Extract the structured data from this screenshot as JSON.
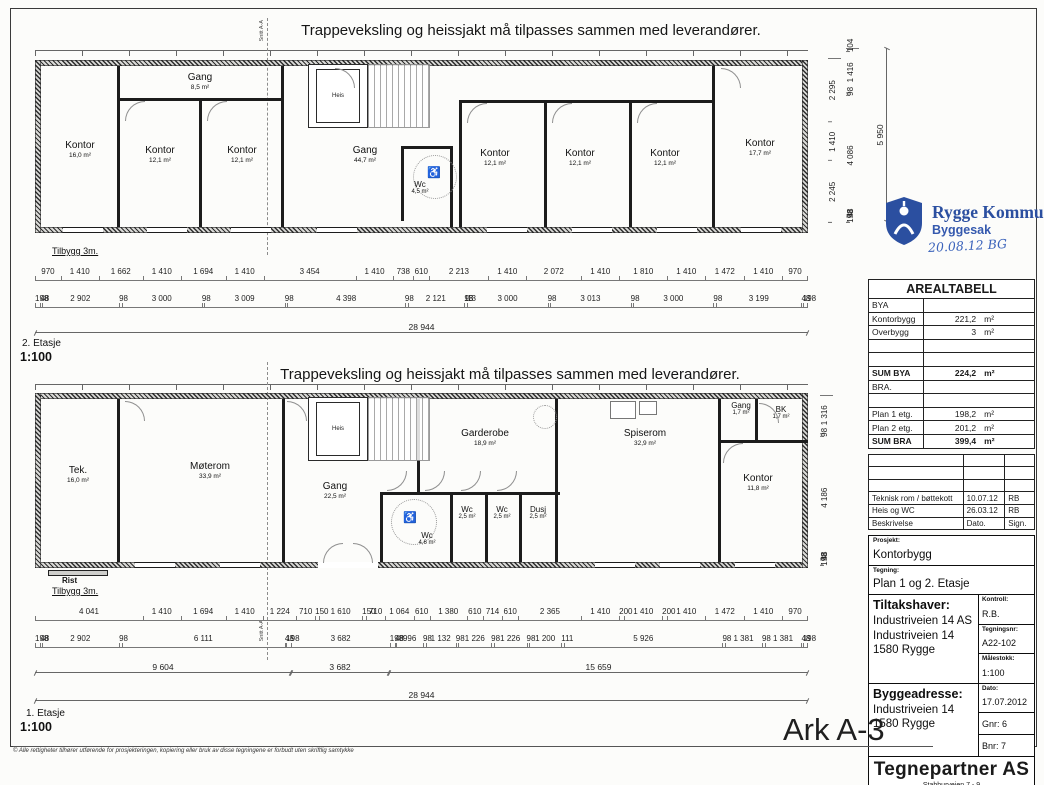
{
  "notes": {
    "top": "Trappeveksling og heissjakt må tilpasses sammen med leverandører.",
    "bottom": "Trappeveksling og heissjakt må tilpasses sammen med leverandører."
  },
  "section_label": "Snitt A-A",
  "ark": "Ark A-3",
  "copyright": "© Alle rettigheter tilhører utførende for prosjekteringen, kopiering eller bruk av disse tegningene er forbudt uten skriftlig samtykke",
  "stamp": {
    "name": "Rygge Kommune",
    "dept": "Byggesak",
    "handwritten": "20.08.12 BG",
    "color": "#2b4fa0"
  },
  "plan2": {
    "floor": "2. Etasje",
    "scale": "1:100",
    "tilbygg": "Tilbygg 3m.",
    "rooms": [
      {
        "name": "Kontor",
        "area": "16,0 m²"
      },
      {
        "name": "Gang",
        "area": "8,5 m²"
      },
      {
        "name": "Kontor",
        "area": "12,1 m²"
      },
      {
        "name": "Kontor",
        "area": "12,1 m²"
      },
      {
        "name": "Heis",
        "area": ""
      },
      {
        "name": "Gang",
        "area": "44,7 m²"
      },
      {
        "name": "Wc",
        "area": "4,5 m²"
      },
      {
        "name": "Kontor",
        "area": "12,1 m²"
      },
      {
        "name": "Kontor",
        "area": "12,1 m²"
      },
      {
        "name": "Kontor",
        "area": "12,1 m²"
      },
      {
        "name": "Kontor",
        "area": "17,7 m²"
      }
    ],
    "dims": {
      "row1": [
        "970",
        "1 410",
        "1 662",
        "1 410",
        "1 694",
        "1 410",
        "3 454",
        "1 410",
        "738",
        "610",
        "2 213",
        "1 410",
        "2 072",
        "1 410",
        "1 810",
        "1 410",
        "1 472",
        "1 410",
        "970"
      ],
      "row2": [
        "198",
        "48",
        "2 902",
        "98",
        "3 000",
        "98",
        "3 009",
        "98",
        "4 398",
        "98",
        "2 121",
        "13",
        "98",
        "13",
        "3 000",
        "98",
        "3 013",
        "98",
        "3 000",
        "98",
        "3 199",
        "48",
        "198"
      ],
      "total": "28 944",
      "right_inner": [
        "2 295",
        "1 410",
        "2 245"
      ],
      "right_outer": [
        "104",
        "1 416",
        "98",
        "4 086",
        "48",
        "198"
      ],
      "right_total": "5 950"
    }
  },
  "plan1": {
    "floor": "1. Etasje",
    "scale": "1:100",
    "tilbygg": "Tilbygg 3m.",
    "rist": "Rist",
    "rooms": [
      {
        "name": "Tek.",
        "area": "16,0 m²"
      },
      {
        "name": "Møterom",
        "area": "33,9 m²"
      },
      {
        "name": "Heis",
        "area": ""
      },
      {
        "name": "Gang",
        "area": "22,5 m²"
      },
      {
        "name": "Garderobe",
        "area": "18,9 m²"
      },
      {
        "name": "Wc",
        "area": "4,6 m²"
      },
      {
        "name": "Wc",
        "area": "2,5 m²"
      },
      {
        "name": "Wc",
        "area": "2,5 m²"
      },
      {
        "name": "Dusj",
        "area": "2,5 m²"
      },
      {
        "name": "Spiserom",
        "area": "32,9 m²"
      },
      {
        "name": "Gang",
        "area": "1,7 m²"
      },
      {
        "name": "BK",
        "area": "1,7 m²"
      },
      {
        "name": "Kontor",
        "area": "11,8 m²"
      }
    ],
    "dims": {
      "row1": [
        "4 041",
        "1 410",
        "1 694",
        "1 410",
        "1 224",
        "710",
        "150",
        "1 610",
        "150",
        "710",
        "1 064",
        "610",
        "1 380",
        "610",
        "714",
        "610",
        "2 365",
        "1 410",
        "200",
        "1 410",
        "200",
        "1 410",
        "1 472",
        "1 410",
        "970"
      ],
      "row2": [
        "198",
        "48",
        "2 902",
        "98",
        "6 111",
        "48",
        "198",
        "3 682",
        "198",
        "48",
        "996",
        "98",
        "1 132",
        "98",
        "1 226",
        "98",
        "1 226",
        "98",
        "1 200",
        "111",
        "5 926",
        "98",
        "1 381",
        "98",
        "1 381",
        "48",
        "198"
      ],
      "row3": [
        "9 604",
        "3 682",
        "15 659"
      ],
      "total": "28 944",
      "right": [
        "1 316",
        "98",
        "4 186",
        "48",
        "198"
      ]
    }
  },
  "arealtabell": {
    "title": "AREALTABELL",
    "rows": [
      {
        "label": "BYA",
        "value": "",
        "unit": ""
      },
      {
        "label": "Kontorbygg",
        "value": "221,2",
        "unit": "m²"
      },
      {
        "label": "Overbygg",
        "value": "3",
        "unit": "m²"
      },
      {
        "label": "",
        "value": "",
        "unit": ""
      },
      {
        "label": "",
        "value": "",
        "unit": ""
      },
      {
        "label": "SUM BYA",
        "value": "224,2",
        "unit": "m²",
        "bold": true
      },
      {
        "label": "BRA.",
        "value": "",
        "unit": ""
      },
      {
        "label": "",
        "value": "",
        "unit": ""
      },
      {
        "label": "Plan 1 etg.",
        "value": "198,2",
        "unit": "m²"
      },
      {
        "label": "Plan 2 etg.",
        "value": "201,2",
        "unit": "m²"
      },
      {
        "label": "SUM BRA",
        "value": "399,4",
        "unit": "m²",
        "bold": true
      }
    ]
  },
  "revisions": {
    "rows": [
      {
        "desc": "",
        "date": "",
        "sign": ""
      },
      {
        "desc": "",
        "date": "",
        "sign": ""
      },
      {
        "desc": "",
        "date": "",
        "sign": ""
      },
      {
        "desc": "Teknisk rom / bøttekott",
        "date": "10.07.12",
        "sign": "RB"
      },
      {
        "desc": "Heis og WC",
        "date": "26.03.12",
        "sign": "RB"
      },
      {
        "desc": "Beskrivelse",
        "date": "Dato.",
        "sign": "Sign."
      }
    ]
  },
  "titleblock": {
    "prosjekt_label": "Prosjekt:",
    "prosjekt": "Kontorbygg",
    "tegning_label": "Tegning:",
    "tegning": "Plan 1 og 2. Etasje",
    "tiltakshaver_label": "Tiltakshaver:",
    "tiltakshaver_1": "Industriveien 14 AS",
    "tiltakshaver_2": "Industriveien 14",
    "tiltakshaver_3": "1580 Rygge",
    "kontroll_label": "Kontroll:",
    "kontroll": "R.B.",
    "tegningsnr_label": "Tegningsnr:",
    "tegningsnr": "A22-102",
    "malestokk_label": "Målestokk:",
    "malestokk": "1:100",
    "byggeadresse_label": "Byggeadresse:",
    "byggeadresse_1": "Industriveien 14",
    "byggeadresse_2": "1580 Rygge",
    "dato_label": "Dato:",
    "dato": "17.07.2012",
    "gnr_label": "Gnr:",
    "gnr": "6",
    "bnr_label": "Bnr:",
    "bnr": "7",
    "firm": "Tegnepartner AS",
    "firm_1": "Stabburveien 7 - 9",
    "firm_2": "1617 Fredrikstad",
    "firm_3": "e-post: rune@tegnepartner.no",
    "firm_4": "internett: tegnepartner.no"
  }
}
